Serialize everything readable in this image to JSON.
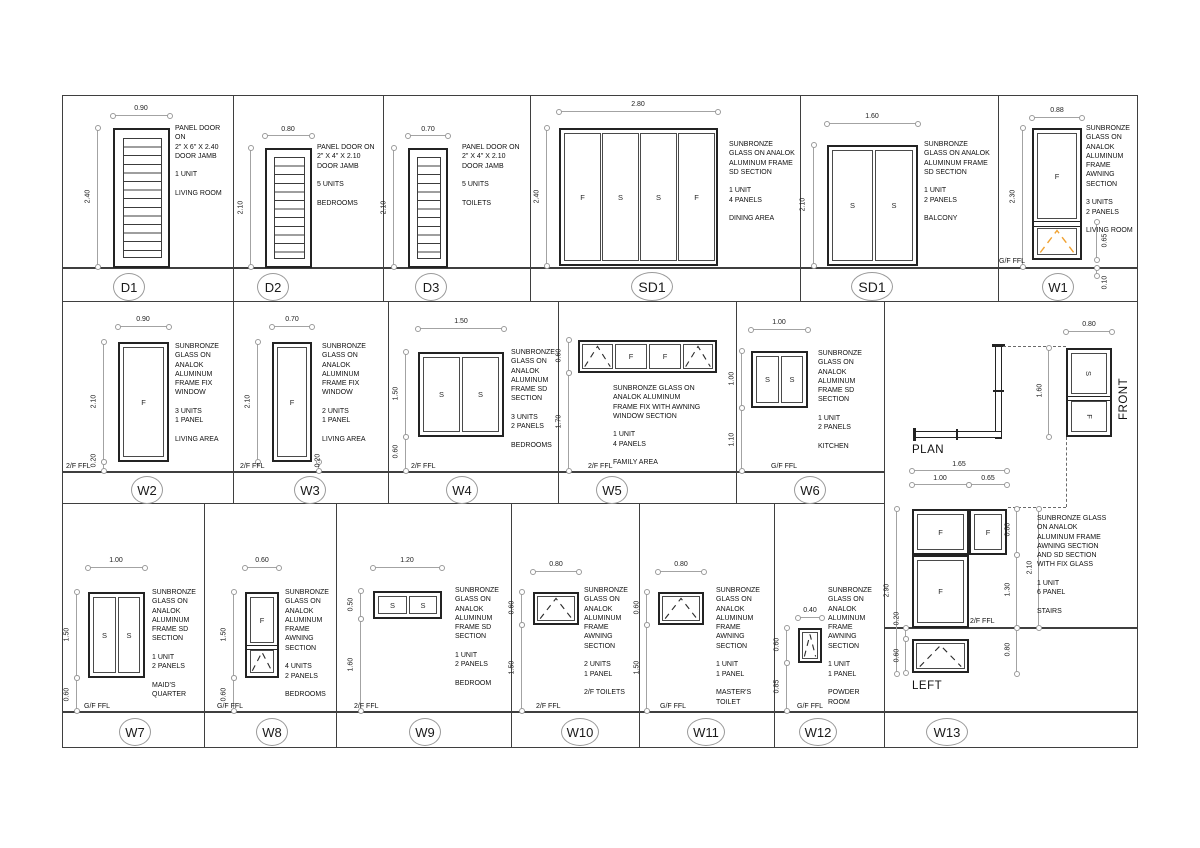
{
  "colors": {
    "awning_accent": "#f0a232",
    "line": "#232323"
  },
  "cells": {
    "d1": {
      "tag": "D1",
      "dim_w": "0.90",
      "dim_h": "2.40",
      "notes": "PANEL DOOR ON\n2\" X 6\" X 2.40\nDOOR JAMB\n\n1 UNIT\n\nLIVING ROOM"
    },
    "d2": {
      "tag": "D2",
      "dim_w": "0.80",
      "dim_h": "2.10",
      "notes": "PANEL DOOR ON\n2\" X 4\" X 2.10\nDOOR JAMB\n\n5 UNITS\n\nBEDROOMS"
    },
    "d3": {
      "tag": "D3",
      "dim_w": "0.70",
      "dim_h": "2.10",
      "notes": "PANEL DOOR ON\n2\" X 4\" X 2.10\nDOOR JAMB\n\n5 UNITS\n\nTOILETS"
    },
    "sd1a": {
      "tag": "SD1",
      "dim_w": "2.80",
      "dim_h": "2.40",
      "panels": [
        "F",
        "S",
        "S",
        "F"
      ],
      "notes": "SUNBRONZE\nGLASS ON ANALOK\nALUMINUM FRAME\nSD SECTION\n\n1 UNIT\n4 PANELS\n\nDINING AREA"
    },
    "sd1b": {
      "tag": "SD1",
      "dim_w": "1.60",
      "dim_h": "2.10",
      "panels": [
        "S",
        "S"
      ],
      "notes": "SUNBRONZE\nGLASS ON ANALOK\nALUMINUM FRAME\nSD SECTION\n\n1 UNIT\n2 PANELS\n\nBALCONY"
    },
    "w1": {
      "tag": "W1",
      "dim_w": "0.88",
      "dim_h": "2.30",
      "dim_awn": "0.65",
      "dim_below": "0.10",
      "panel": "F",
      "ffl": "G/F FFL",
      "notes": "SUNBRONZE\nGLASS ON\nANALOK\nALUMINUM\nFRAME\nAWNING\nSECTION\n\n3 UNITS\n2 PANELS\n\nLIVING ROOM"
    },
    "w2": {
      "tag": "W2",
      "dim_w": "0.90",
      "dim_h": "2.10",
      "dim_off": "0.20",
      "panel": "F",
      "ffl": "2/F FFL",
      "notes": "SUNBRONZE\nGLASS ON\nANALOK\nALUMINUM\nFRAME FIX\nWINDOW\n\n3 UNITS\n1 PANEL\n\nLIVING AREA"
    },
    "w3": {
      "tag": "W3",
      "dim_w": "0.70",
      "dim_h": "2.10",
      "dim_off": "0.20",
      "panel": "F",
      "ffl": "2/F FFL",
      "notes": "SUNBRONZE\nGLASS ON\nANALOK\nALUMINUM\nFRAME FIX\nWINDOW\n\n2 UNITS\n1 PANEL\n\nLIVING AREA"
    },
    "w4": {
      "tag": "W4",
      "dim_w": "1.50",
      "dim_h": "1.50",
      "dim_off": "0.60",
      "panels": [
        "S",
        "S"
      ],
      "ffl": "2/F FFL",
      "notes": "SUNBRONZE\nGLASS ON\nANALOK\nALUMINUM\nFRAME SD\nSECTION\n\n3 UNITS\n2 PANELS\n\nBEDROOMS"
    },
    "w5": {
      "tag": "W5",
      "dim_h": "0.60",
      "dim_off": "1.70",
      "panels": [
        "F",
        "F"
      ],
      "ffl": "2/F FFL",
      "notes": "SUNBRONZE GLASS ON\nANALOK ALUMINUM\nFRAME FIX WITH AWNING\nWINDOW SECTION\n\n1 UNIT\n4 PANELS\n\nFAMILY AREA"
    },
    "w6": {
      "tag": "W6",
      "dim_w": "1.00",
      "dim_h": "1.00",
      "dim_off": "1.10",
      "panels": [
        "S",
        "S"
      ],
      "ffl": "G/F FFL",
      "notes": "SUNBRONZE\nGLASS ON\nANALOK\nALUMINUM\nFRAME SD\nSECTION\n\n1 UNIT\n2 PANELS\n\nKITCHEN"
    },
    "w7": {
      "tag": "W7",
      "dim_w": "1.00",
      "dim_h": "1.50",
      "dim_off": "0.60",
      "panels": [
        "S",
        "S"
      ],
      "ffl": "G/F FFL",
      "notes": "SUNBRONZE\nGLASS ON\nANALOK\nALUMINUM\nFRAME SD\nSECTION\n\n1 UNIT\n2 PANELS\n\nMAID'S\nQUARTER"
    },
    "w8": {
      "tag": "W8",
      "dim_w": "0.60",
      "dim_h": "1.50",
      "dim_off": "0.60",
      "panel": "F",
      "ffl": "G/F FFL",
      "notes": "SUNBRONZE\nGLASS ON\nANALOK\nALUMINUM\nFRAME\nAWNING\nSECTION\n\n4 UNITS\n2 PANELS\n\nBEDROOMS"
    },
    "w9": {
      "tag": "W9",
      "dim_w": "1.20",
      "dim_h": "0.50",
      "dim_off": "1.60",
      "panels": [
        "S",
        "S"
      ],
      "ffl": "2/F FFL",
      "notes": "SUNBRONZE\nGLASS ON\nANALOK\nALUMINUM\nFRAME SD\nSECTION\n\n1 UNIT\n2 PANELS\n\nBEDROOM"
    },
    "w10": {
      "tag": "W10",
      "dim_w": "0.80",
      "dim_h": "0.60",
      "dim_off": "1.50",
      "ffl": "2/F FFL",
      "notes": "SUNBRONZE\nGLASS ON\nANALOK\nALUMINUM\nFRAME\nAWNING\nSECTION\n\n2 UNITS\n1 PANEL\n\n2/F TOILETS"
    },
    "w11": {
      "tag": "W11",
      "dim_w": "0.80",
      "dim_h": "0.60",
      "dim_off": "1.50",
      "ffl": "G/F FFL",
      "notes": "SUNBRONZE\nGLASS ON\nANALOK\nALUMINUM\nFRAME\nAWNING\nSECTION\n\n1 UNIT\n1 PANEL\n\nMASTER'S\nTOILET"
    },
    "w12": {
      "tag": "W12",
      "dim_w": "0.40",
      "dim_h": "0.60",
      "dim_off": "0.85",
      "ffl": "G/F FFL",
      "notes": "SUNBRONZE\nGLASS ON\nANALOK\nALUMINUM\nFRAME\nAWNING\nSECTION\n\n1 UNIT\n1 PANEL\n\nPOWDER\nROOM"
    },
    "w13": {
      "tag": "W13",
      "plan_label": "PLAN",
      "front_label": "FRONT",
      "left_label": "LEFT",
      "ffl": "2/F FFL",
      "front_panels": [
        "S",
        "F"
      ],
      "left_panels": [
        "F",
        "F",
        "F"
      ],
      "dim_total_w": "1.65",
      "dim_w1": "1.00",
      "dim_w2": "0.65",
      "dim_total_h": "2.90",
      "dim_gap": "0.20",
      "dim_awn": "0.60",
      "dim_top": "0.80",
      "dim_upper": "2.10",
      "dim_mid": "1.30",
      "dim_below": "0.80",
      "dim_front_w": "0.80",
      "dim_front_h": "1.60",
      "notes": "SUNBRONZE GLASS\nON ANALOK\nALUMINUM FRAME\nAWNING SECTION\nAND SD SECTION\nWITH FIX GLASS\n\n1 UNIT\n6 PANEL\n\nSTAIRS"
    }
  }
}
